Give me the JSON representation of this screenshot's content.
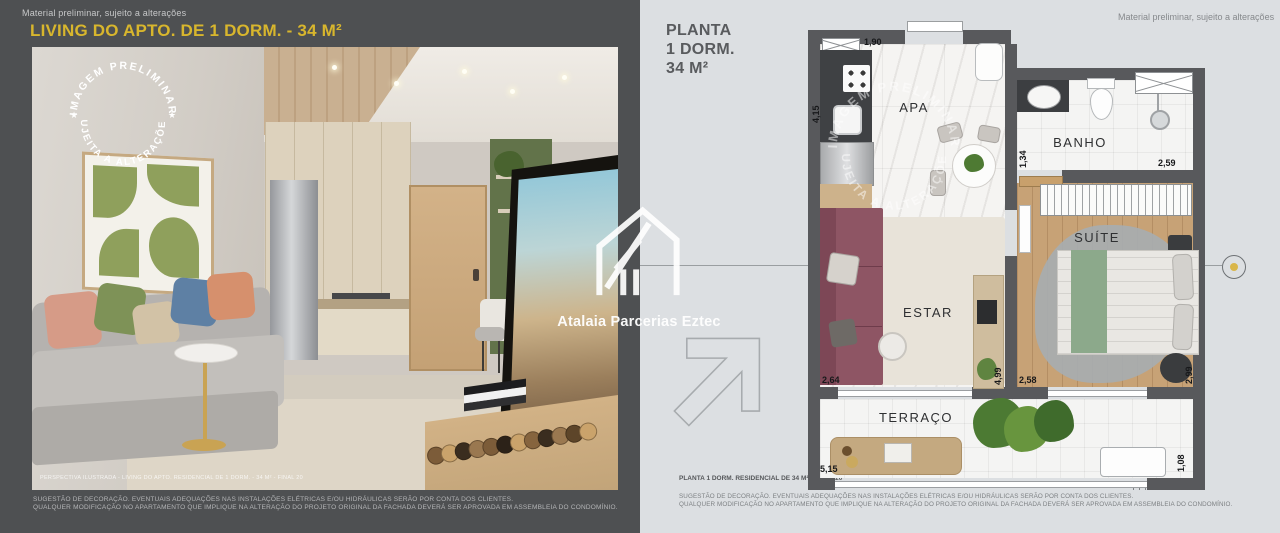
{
  "meta": {
    "preliminary_note": "Material preliminar, sujeito a alterações"
  },
  "stamp": {
    "top": "IMAGEM PRELIMINAR",
    "bottom": "SUJEITA A ALTERAÇÕES",
    "star_left": "★",
    "star_right": "★"
  },
  "brand": {
    "name": "Atalaia Parcerias Eztec"
  },
  "disclaimers": {
    "line1": "SUGESTÃO DE DECORAÇÃO. EVENTUAIS ADEQUAÇÕES NAS INSTALAÇÕES ELÉTRICAS E/OU HIDRÁULICAS SERÃO POR CONTA DOS CLIENTES.",
    "line2": "QUALQUER MODIFICAÇÃO NO APARTAMENTO QUE IMPLIQUE NA ALTERAÇÃO DO PROJETO ORIGINAL DA FACHADA DEVERÁ SER APROVADA EM ASSEMBLEIA DO CONDOMÍNIO."
  },
  "left_panel": {
    "title": "LIVING DO APTO. DE 1 DORM. - 34 M²",
    "photo_caption": "PERSPECTIVA ILUSTRADA - LIVING DO APTO. RESIDENCIAL DE 1 DORM. - 34 M² - FINAL 20"
  },
  "right_panel": {
    "title": {
      "line1": "PLANTA",
      "line2": "1 DORM.",
      "line3": "34 M²"
    },
    "plan_caption": "PLANTA 1 DORM. RESIDENCIAL DE 34 M² - FINAL 20",
    "rooms": {
      "kitchen": "APA",
      "bathroom": "BANHO",
      "suite": "SUÍTE",
      "living": "ESTAR",
      "terrace": "TERRAÇO"
    },
    "dimensions": {
      "kitchen_width": "1,90",
      "kitchen_height": "4,15",
      "bathroom_height": "1,34",
      "bathroom_width": "2,59",
      "living_width": "2,64",
      "living_height": "4,99",
      "suite_width": "2,58",
      "suite_height": "2,99",
      "terrace_width": "5,15",
      "terrace_height": "1,08"
    }
  },
  "colors": {
    "accent_gold": "#d8b62d",
    "panel_dark": "#4e5052",
    "panel_light": "#dcdfe2",
    "wall": "#58595c",
    "marker_dot": "#d9b64a"
  }
}
